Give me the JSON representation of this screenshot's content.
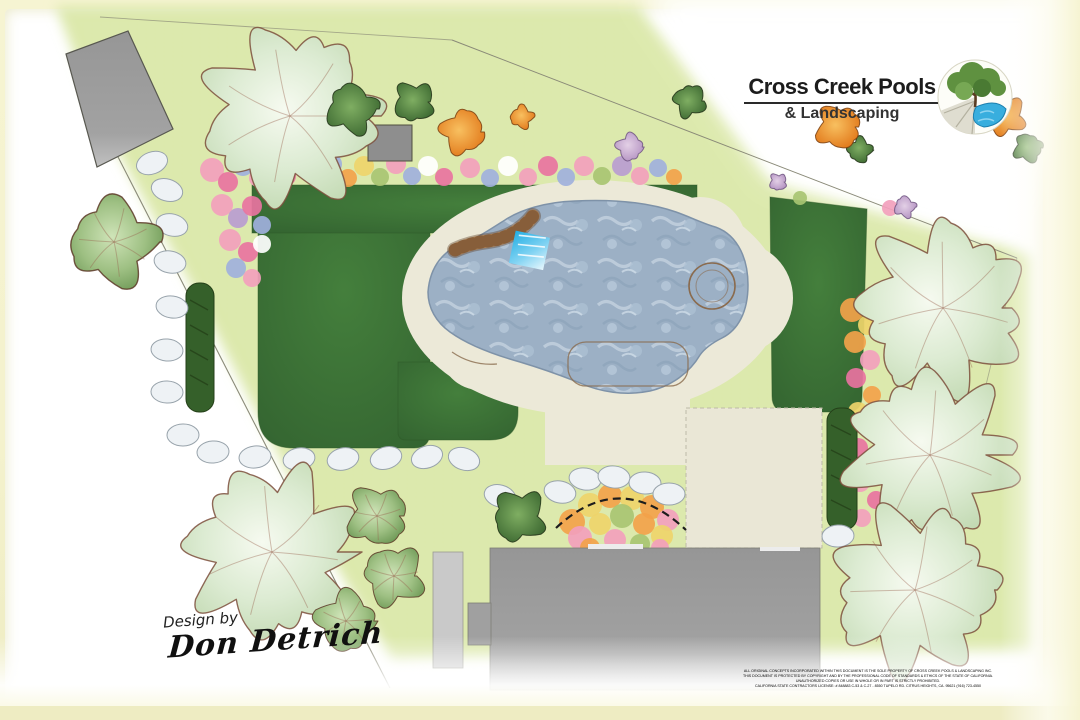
{
  "logo": {
    "title": "Cross Creek Pools",
    "subtitle": "& Landscaping",
    "emblem_icon": "tree-over-pond-and-path-logo"
  },
  "signature": {
    "prefix": "Design by",
    "name": "Don Detrich"
  },
  "legal": {
    "line1": "ALL ORIGINAL CONCEPTS INCORPORATED WITHIN THIS DOCUMENT IS THE SOLE PROPERTY OF CROSS CREEK POOLS & LANDSCAPING INC.",
    "line2": "THIS DOCUMENT IS PROTECTED BY COPYRIGHT AND BY THE PROFESSIONAL CODE OF STANDARDS & ETHICS OF THE STATE OF CALIFORNIA.",
    "line3": "UNAUTHORIZED COPIES OR USE IN WHOLE OR IN PART IS STRICTLY PROHIBITED.",
    "line4": "CALIFORNIA STATE CONTRACTORS LICENSE:   # 848883   C-53 & C-27 - 8550 TUPELO RD.   CITRUS HEIGHTS, CA.  95621 (916) 723-4550"
  },
  "plan_colors": {
    "page_border": "#f5f3d0",
    "ground_wash": "#dde9ad",
    "lawn_green": "#3d7837",
    "deck_cream": "#ece9d8",
    "pool_water": "#9cb0c5",
    "waterfall_blue": "#2bb4e6",
    "stone_wall_brown": "#a87c50",
    "house_gray": "#9c9c9c",
    "hedge_green": "#35602a"
  }
}
